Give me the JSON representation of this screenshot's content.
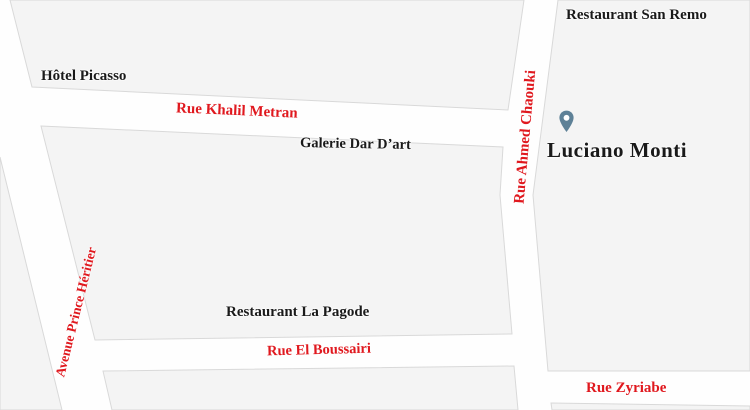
{
  "map": {
    "type": "street-map",
    "colors": {
      "street_label": "#e0181e",
      "place_label": "#1a1a1a",
      "block_fill": "#f4f4f4",
      "block_edge": "#d9d9d9",
      "street_fill": "#ffffff",
      "pin": "#5e8197"
    },
    "streets": [
      {
        "name": "rue-khalil-metran",
        "label": "Rue Khalil Metran",
        "orientation": "horizontal"
      },
      {
        "name": "rue-ahmed-chaouki",
        "label": "Rue Ahmed Chaouki",
        "orientation": "vertical"
      },
      {
        "name": "avenue-prince-heritier",
        "label": "Avenue Prince Héritier",
        "orientation": "diagonal"
      },
      {
        "name": "rue-el-boussairi",
        "label": "Rue El Boussairi",
        "orientation": "horizontal"
      },
      {
        "name": "rue-zyriabe",
        "label": "Rue Zyriabe",
        "orientation": "horizontal"
      }
    ],
    "places": [
      {
        "name": "restaurant-san-remo",
        "label": "Restaurant San Remo"
      },
      {
        "name": "hotel-picasso",
        "label": "Hôtel Picasso"
      },
      {
        "name": "galerie-dar-dart",
        "label": "Galerie Dar D’art"
      },
      {
        "name": "restaurant-la-pagode",
        "label": "Restaurant La Pagode"
      },
      {
        "name": "luciano-monti",
        "label": "Luciano Monti",
        "marker": "location-pin"
      }
    ]
  }
}
